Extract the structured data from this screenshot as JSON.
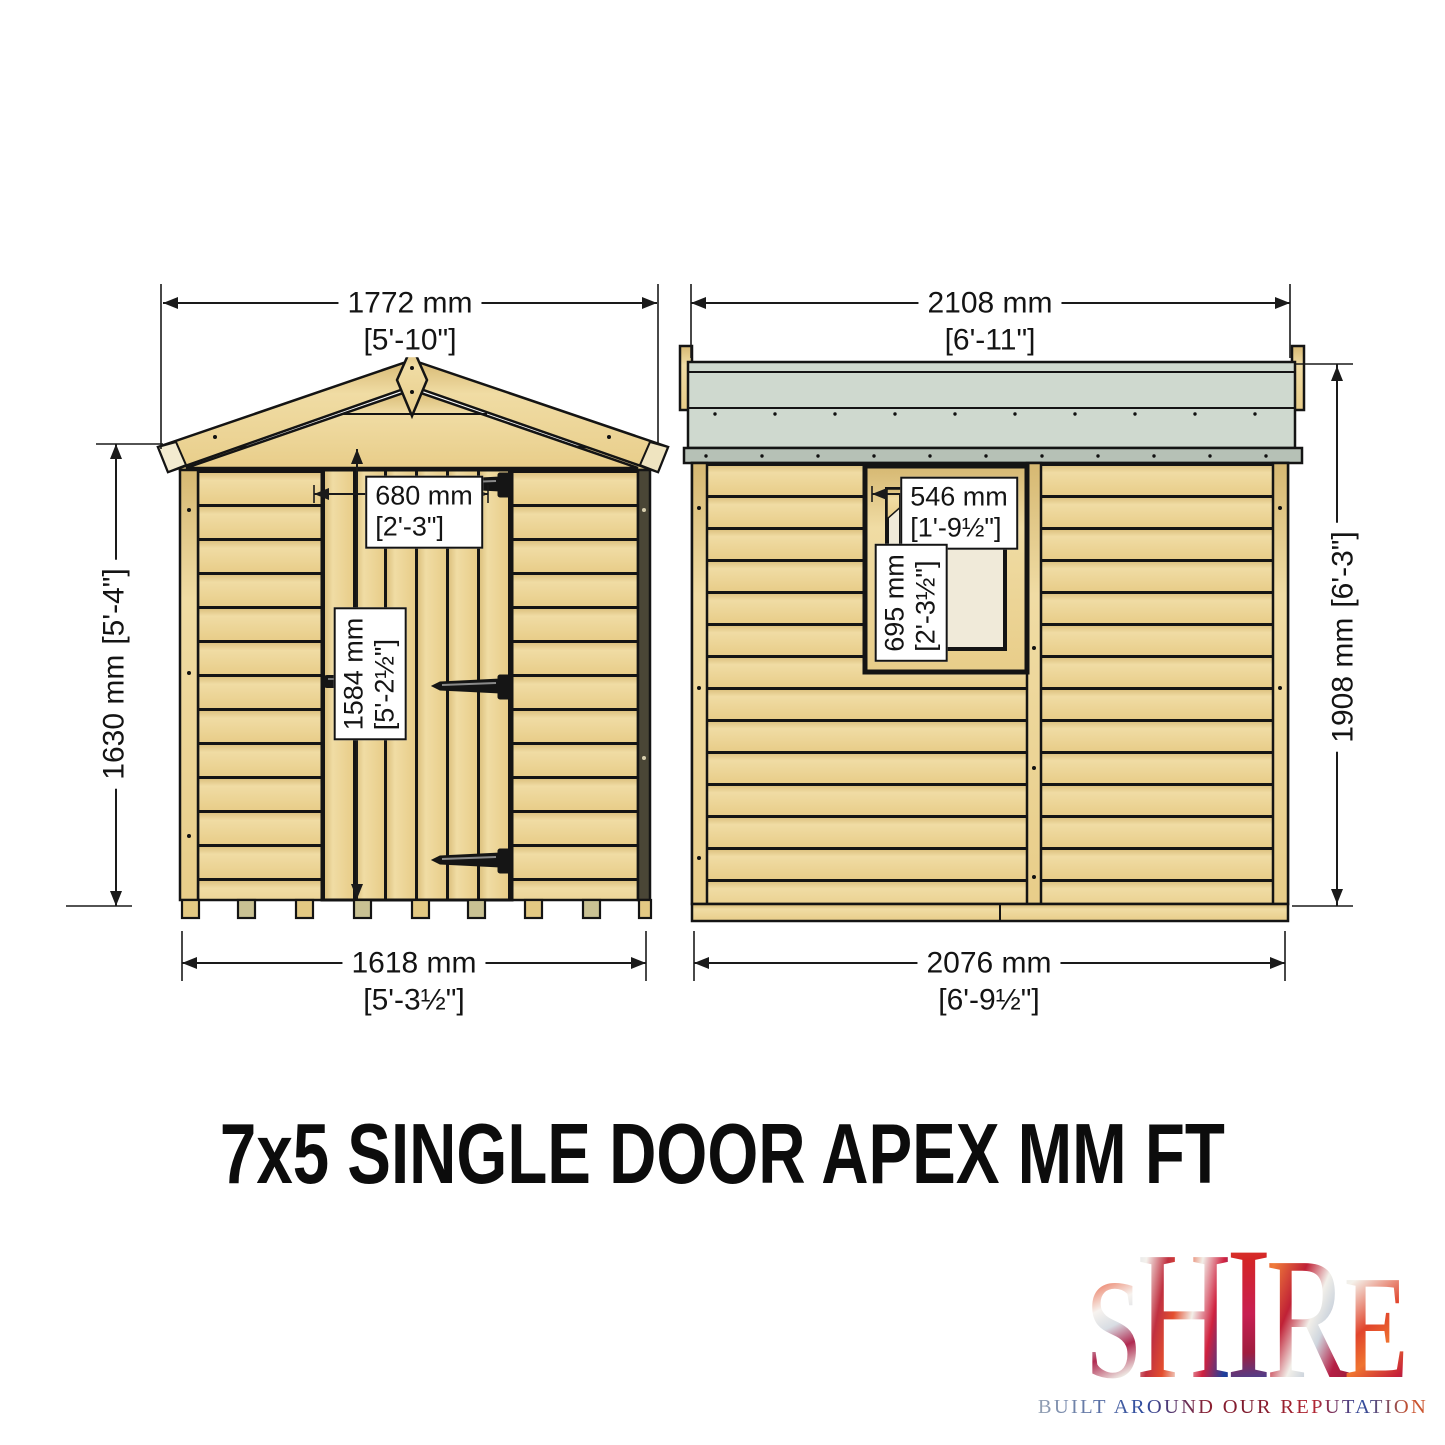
{
  "title": "7x5 SINGLE DOOR APEX MM FT",
  "front": {
    "width_top": {
      "mm": "1772 mm",
      "ft": "[5'-10\"]"
    },
    "height": {
      "mm": "1630 mm",
      "ft": "[5'-4\"]"
    },
    "door_width": {
      "mm": "680 mm",
      "ft": "[2'-3\"]"
    },
    "door_height": {
      "mm": "1584 mm",
      "ft": "[5'-2½\"]"
    },
    "width_bottom": {
      "mm": "1618 mm",
      "ft": "[5'-3½\"]"
    }
  },
  "side": {
    "width_top": {
      "mm": "2108 mm",
      "ft": "[6'-11\"]"
    },
    "window_width": {
      "mm": "546 mm",
      "ft": "[1'-9½\"]"
    },
    "window_height": {
      "mm": "695 mm",
      "ft": "[2'-3½\"]"
    },
    "height": {
      "mm": "1908 mm",
      "ft": "[6'-3\"]"
    },
    "width_bottom": {
      "mm": "2076 mm",
      "ft": "[6'-9½\"]"
    }
  },
  "logo": {
    "l0": "S",
    "l1": "H",
    "l2": "I",
    "l3": "R",
    "l4": "E",
    "tagline": "BUILT AROUND OUR REPUTATION"
  },
  "colors": {
    "wood": "#e8cd89",
    "wood_light": "#f0dca4",
    "wood_dark": "#d6b872",
    "roof_felt": "#cfd9cf",
    "roof_fascia": "#b6c1b6",
    "glass": "#f0ead9",
    "outline": "#1a1a1a"
  }
}
